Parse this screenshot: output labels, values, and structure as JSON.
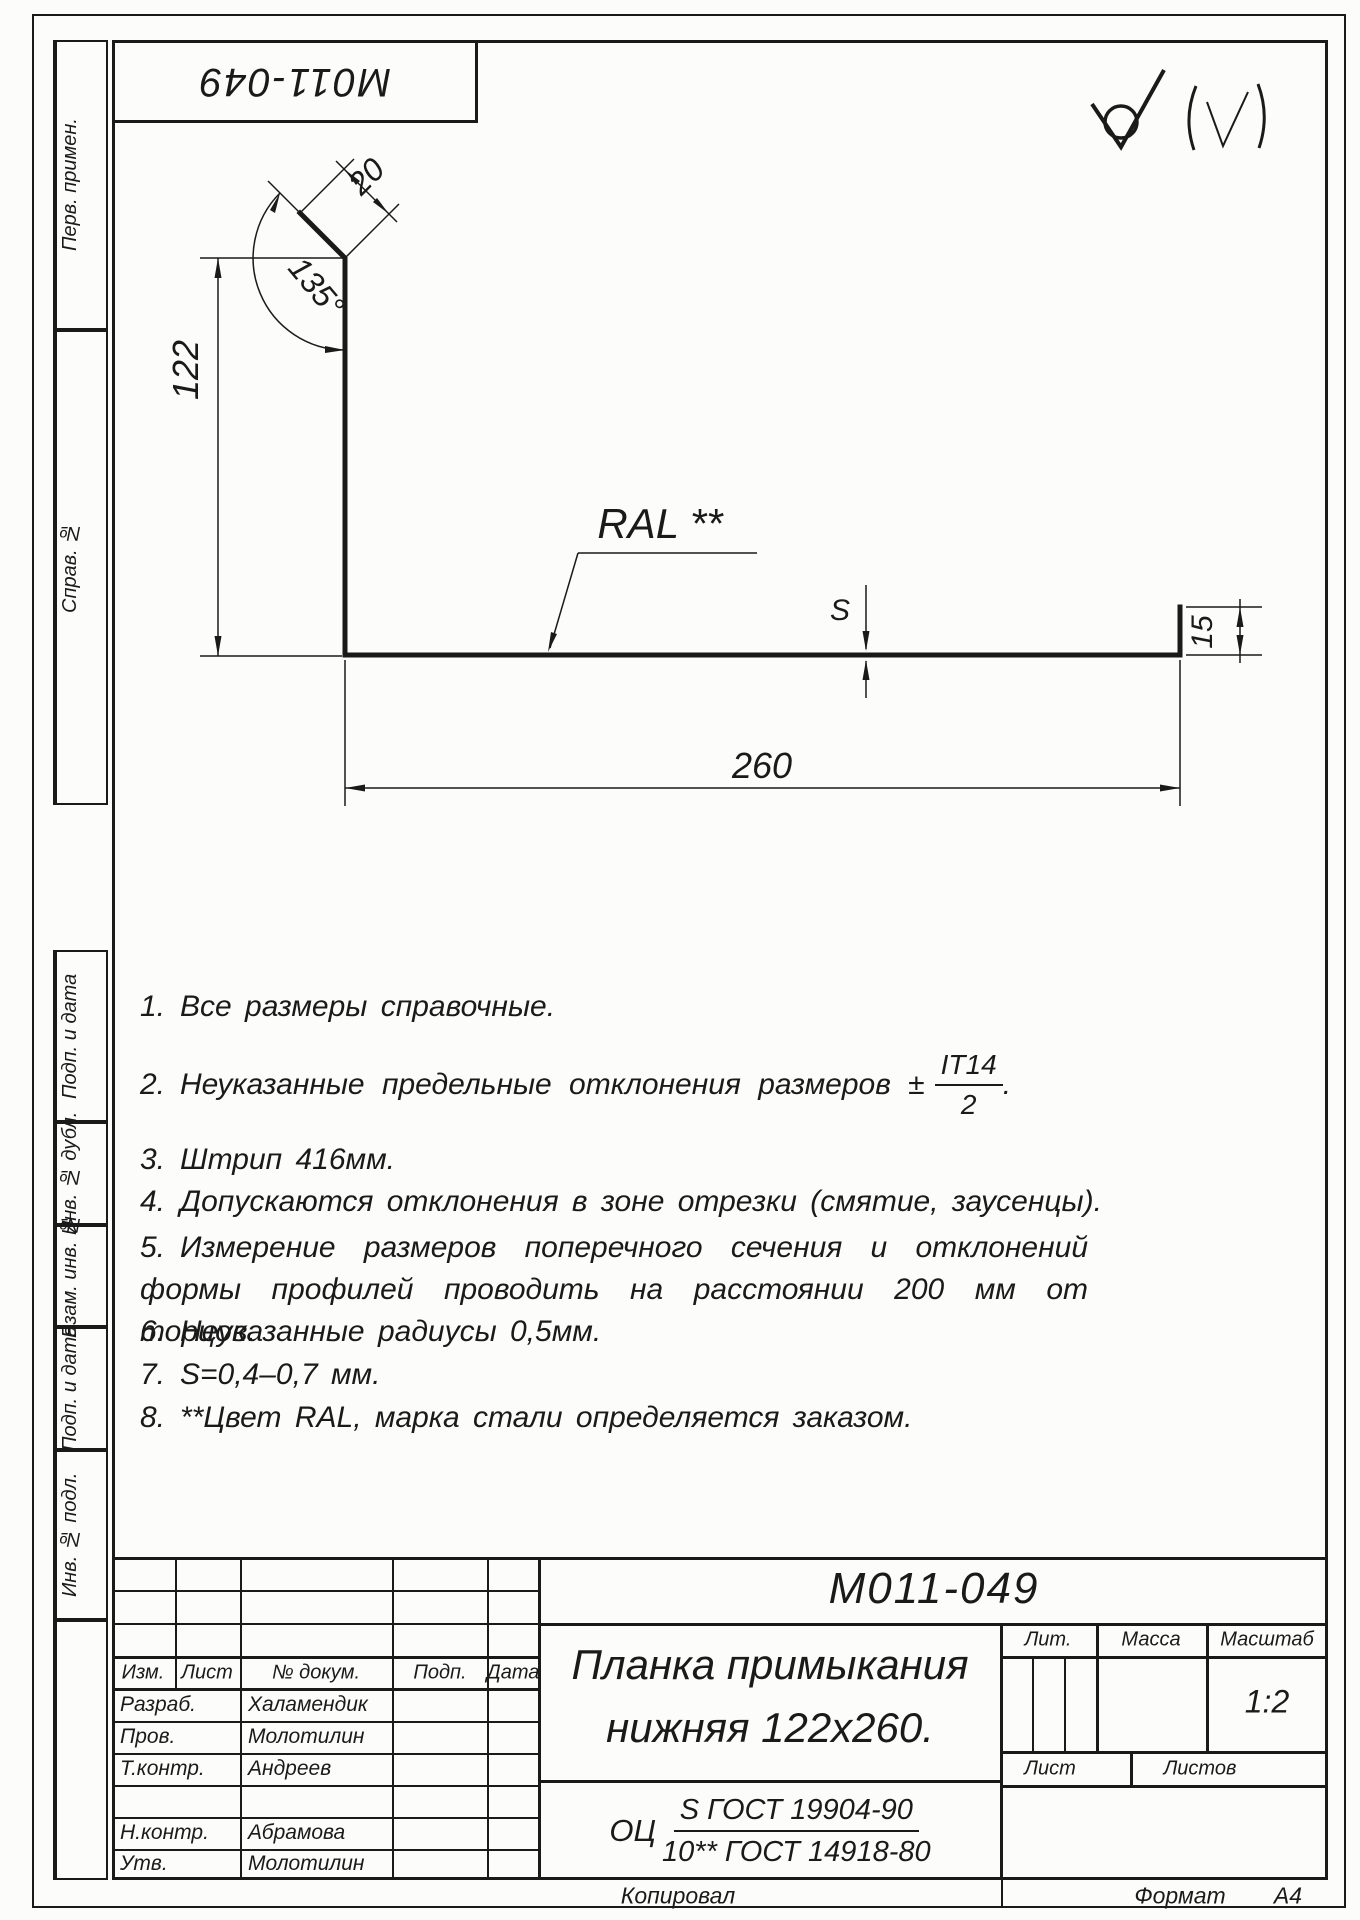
{
  "stamp_top_left": {
    "number": "M011-049"
  },
  "roughness": {
    "main_symbol": "no-machining-check-with-circle",
    "note_symbol": "parenthesized-check"
  },
  "drawing": {
    "labels": {
      "height": "122",
      "flange": "20",
      "angle": "135°",
      "length": "260",
      "lip": "15",
      "thickness": "S",
      "coating": "RAL **"
    }
  },
  "notes": [
    {
      "num": "1.",
      "text": "Все размеры справочные."
    },
    {
      "num": "2.",
      "text": "Неуказанные предельные отклонения размеров ±",
      "frac_num": "IT14",
      "frac_den": "2",
      "suffix": "."
    },
    {
      "num": "3.",
      "text": "Штрип 416мм."
    },
    {
      "num": "4.",
      "text": "Допускаются отклонения в зоне отрезки (смятие, заусенцы)."
    },
    {
      "num": "5.",
      "text": "Измерение размеров поперечного сечения и отклонений формы профилей проводить на расстоянии 200 мм от торцов."
    },
    {
      "num": "6.",
      "text": "Неуказанные радиусы 0,5мм."
    },
    {
      "num": "7.",
      "text": "S=0,4–0,7 мм."
    },
    {
      "num": "8.",
      "text": "**Цвет RAL, марка стали определяется заказом."
    }
  ],
  "side_columns": {
    "perv_primen": "Перв. примен.",
    "sprav_no": "Справ. №",
    "podp_data_1": "Подп. и дата",
    "inv_dubl": "Инв. № дубл.",
    "vzam_inv": "Взам. инв. №",
    "podp_data_2": "Подп. и дата",
    "inv_podl": "Инв. № подл."
  },
  "title_block": {
    "designation": "M011-049",
    "name_line1": "Планка примыкания",
    "name_line2": "нижняя 122x260.",
    "material": {
      "prefix": "ОЦ",
      "numerator": "S ГОСТ 19904-90",
      "denominator": "10** ГОСТ 14918-80"
    },
    "headers": {
      "izm": "Изм.",
      "list": "Лист",
      "num_doc": "№ докум.",
      "podp": "Подп.",
      "data": "Дата"
    },
    "roles": {
      "razrab": "Разраб.",
      "prov": "Пров.",
      "tkontr": "Т.контр.",
      "nkontr": "Н.контр.",
      "utv": "Утв."
    },
    "names": {
      "razrab": "Халамендик",
      "prov": "Молотилин",
      "tkontr": "Андреев",
      "nkontr": "Абрамова",
      "utv": "Молотилин"
    },
    "lit_label": "Лит.",
    "massa_label": "Масса",
    "masshtab_label": "Масштаб",
    "scale_value": "1:2",
    "list_label": "Лист",
    "listov_label": "Листов"
  },
  "footer": {
    "kopiroval": "Копировал",
    "format_label": "Формат",
    "format_value": "A4"
  }
}
